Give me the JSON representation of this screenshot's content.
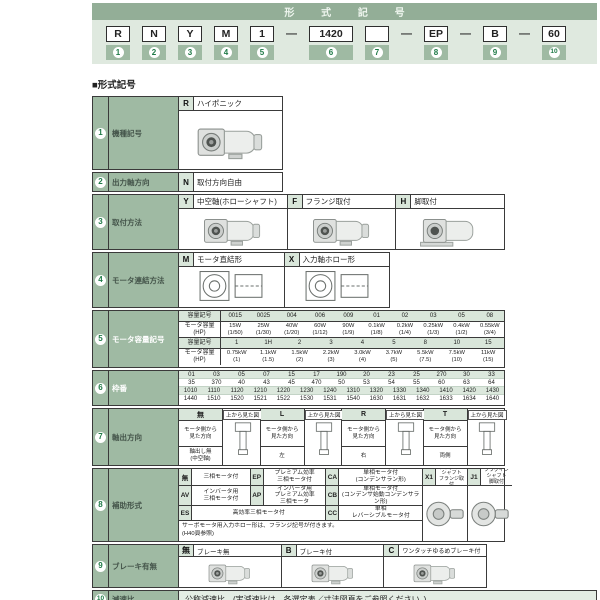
{
  "page": {
    "section_title": "■形式記号"
  },
  "header": {
    "title": "形 式 記 号",
    "dash": "—",
    "units": [
      {
        "code": "R",
        "num": "1"
      },
      {
        "code": "N",
        "num": "2"
      },
      {
        "code": "Y",
        "num": "3"
      },
      {
        "code": "M",
        "num": "4"
      },
      {
        "code": "1",
        "num": "5"
      },
      {
        "code": "1420",
        "num": "6"
      },
      {
        "code": "",
        "num": "7"
      },
      {
        "code": "EP",
        "num": "8"
      },
      {
        "code": "B",
        "num": "9"
      },
      {
        "code": "60",
        "num": "10"
      }
    ]
  },
  "rows": {
    "r1": {
      "num": "1",
      "label": "機種記号",
      "code": "R",
      "desc": "ハイポニック"
    },
    "r2": {
      "num": "2",
      "label": "出力軸方向",
      "code": "N",
      "desc": "取付方向自由"
    },
    "r3": {
      "num": "3",
      "label": "取付方法",
      "options": [
        {
          "code": "Y",
          "desc": "中空軸(ホローシャフト)"
        },
        {
          "code": "F",
          "desc": "フランジ取付"
        },
        {
          "code": "H",
          "desc": "脚取付"
        }
      ]
    },
    "r4": {
      "num": "4",
      "label": "モータ連結方法",
      "options": [
        {
          "code": "M",
          "desc": "モータ直結形"
        },
        {
          "code": "X",
          "desc": "入力軸ホロー形"
        }
      ]
    },
    "r5": {
      "num": "5",
      "label": "モータ容量記号",
      "row_label_code": "容量記号",
      "row_label_cap": "モータ容量\n(HP)",
      "g1_codes": [
        "0015",
        "0025",
        "004",
        "006",
        "009",
        "01",
        "02",
        "03",
        "05",
        "08"
      ],
      "g1_caps": [
        "15W\n(1/50)",
        "25W\n(1/30)",
        "40W\n(1/20)",
        "60W\n(1/12)",
        "90W\n(1/9)",
        "0.1kW\n(1/8)",
        "0.2kW\n(1/4)",
        "0.25kW\n(1/3)",
        "0.4kW\n(1/2)",
        "0.55kW\n(3/4)"
      ],
      "g2_codes": [
        "1",
        "1H",
        "2",
        "3",
        "4",
        "5",
        "8",
        "10",
        "15"
      ],
      "g2_caps": [
        "0.75kW\n(1)",
        "1.1kW\n(1.5)",
        "1.5kW\n(2)",
        "2.2kW\n(3)",
        "3.0kW\n(4)",
        "3.7kW\n(5)",
        "5.5kW\n(7.5)",
        "7.5kW\n(10)",
        "11kW\n(15)"
      ]
    },
    "r6": {
      "num": "6",
      "label": "枠番",
      "line1": [
        "01",
        "03",
        "05",
        "07",
        "15",
        "17",
        "190",
        "20",
        "23",
        "25",
        "270",
        "30",
        "33"
      ],
      "line2": [
        "35",
        "370",
        "40",
        "43",
        "45",
        "470",
        "50",
        "53",
        "54",
        "55",
        "60",
        "63",
        "64"
      ],
      "line3": [
        "1010",
        "1110",
        "1120",
        "1210",
        "1220",
        "1230",
        "1240",
        "1310",
        "1320",
        "1330",
        "1340",
        "1410",
        "1420",
        "1430"
      ],
      "line4": [
        "1440",
        "1510",
        "1520",
        "1521",
        "1522",
        "1530",
        "1531",
        "1540",
        "1630",
        "1631",
        "1632",
        "1633",
        "1634",
        "1640"
      ]
    },
    "r7": {
      "num": "7",
      "label": "軸出方向",
      "view_note": "上から見た図",
      "dir_note": "モータ側から\n見た方向",
      "options": [
        {
          "code": "無",
          "dir": "軸出し無\n(中空軸)"
        },
        {
          "code": "L",
          "dir": "左"
        },
        {
          "code": "R",
          "dir": "右"
        },
        {
          "code": "T",
          "dir": "両側"
        }
      ]
    },
    "r8": {
      "num": "8",
      "label": "補助形式",
      "cells": [
        {
          "code": "無",
          "desc": "三相モータ付"
        },
        {
          "code": "EP",
          "desc": "プレミアム効率\n三相モータ付"
        },
        {
          "code": "CA",
          "desc": "単相モータ付\n(コンデンサラン形)"
        },
        {
          "code": "X1",
          "desc": "プラグインシャフト\nフランジ取付"
        },
        {
          "code": "J1",
          "desc": "プラグインシャフト\n脚取付"
        },
        {
          "code": "AV",
          "desc": "インバータ用\n三相モータ付"
        },
        {
          "code": "AP",
          "desc": "インバータ用\nプレミアム効率\n三相モータ"
        },
        {
          "code": "CB",
          "desc": "単相モータ付\n(コンデンサ始動コンデンサラン形)"
        },
        {
          "code": "ES",
          "desc": "高効率三相モータ付"
        },
        {
          "code": "CC",
          "desc": "単相\nレバーシブルモータ付"
        }
      ],
      "note": "サーボモータ用入力ホロー形は、フランジ記号が付きます。\n(H40頁参照)"
    },
    "r9": {
      "num": "9",
      "label": "ブレーキ有無",
      "options": [
        {
          "code": "無",
          "desc": "ブレーキ無"
        },
        {
          "code": "B",
          "desc": "ブレーキ付"
        },
        {
          "code": "C",
          "desc": "ワンタッチゆるめブレーキ付"
        }
      ]
    },
    "r10": {
      "num": "10",
      "label": "減速比",
      "desc": "公称減速比　(実減速比は、各選定表／寸法図頁をご参照ください。)"
    }
  }
}
